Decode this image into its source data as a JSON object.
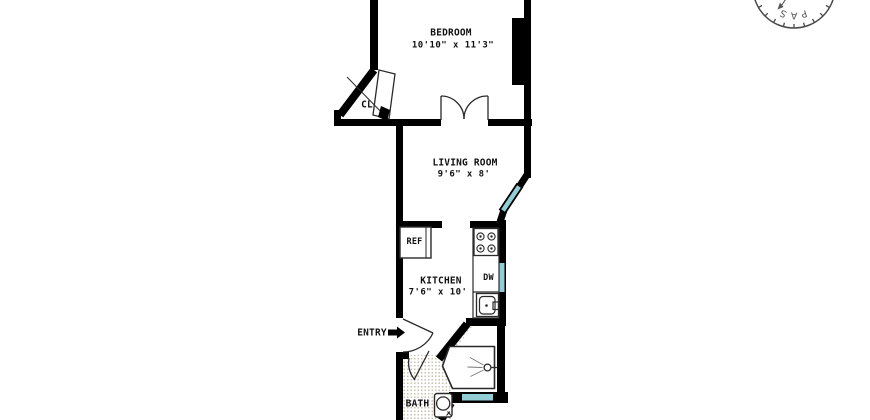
{
  "plan": {
    "rooms": {
      "bedroom": {
        "name": "BEDROOM",
        "dims": "10'10\" x 11'3\""
      },
      "living_room": {
        "name": "LIVING ROOM",
        "dims": "9'6\" x 8'"
      },
      "kitchen": {
        "name": "KITCHEN",
        "dims": "7'6\" x 10'"
      },
      "bath": {
        "name": "BATH"
      },
      "closet": {
        "name": "CL"
      },
      "entry": {
        "name": "ENTRY"
      }
    },
    "fixtures": {
      "refrigerator": "REF",
      "dishwasher": "DW"
    },
    "compass": {
      "visible_text": "PASS"
    },
    "colors": {
      "wall": "#000000",
      "window_glass": "#93ced6",
      "label_text": "#111111",
      "tile_dot": "#c9c0ae",
      "compass_stroke": "#4a4a4a"
    }
  }
}
